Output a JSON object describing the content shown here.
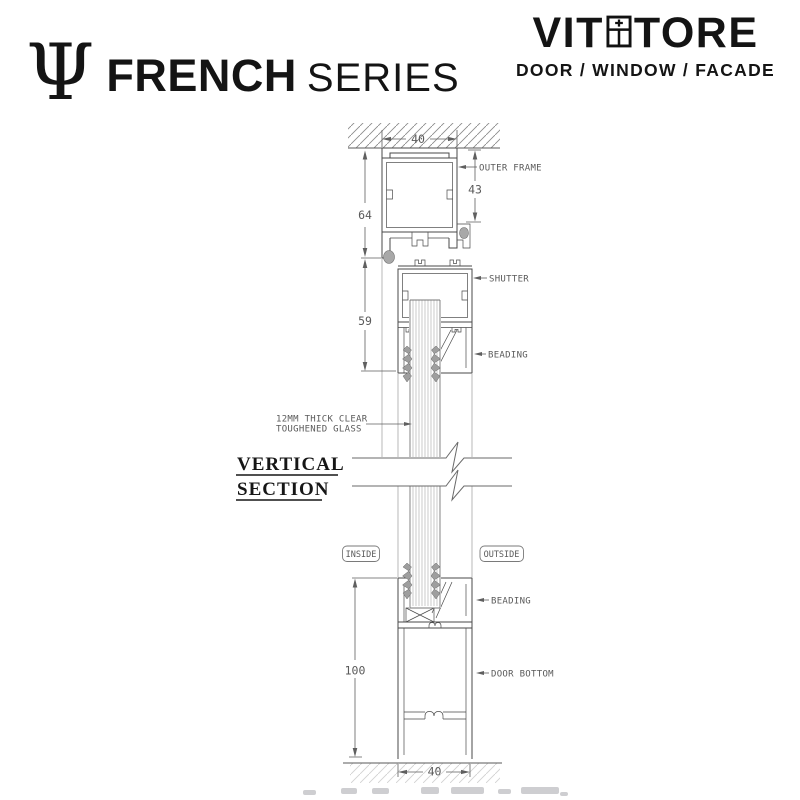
{
  "brand_left": {
    "symbol": "Ψ",
    "title": "FRENCH",
    "subtitle": "SERIES"
  },
  "brand_right": {
    "name_prefix": "VIT",
    "name_suffix": "TORE",
    "tagline": "DOOR / WINDOW / FACADE"
  },
  "drawing": {
    "title_line1": "VERTICAL",
    "title_line2": "SECTION",
    "labels": {
      "outer_frame": "OUTER FRAME",
      "shutter": "SHUTTER",
      "beading_top": "BEADING",
      "glass_line1": "12MM THICK CLEAR",
      "glass_line2": "TOUGHENED GLASS",
      "inside": "INSIDE",
      "outside": "OUTSIDE",
      "beading_bottom": "BEADING",
      "door_bottom": "DOOR BOTTOM"
    },
    "dimensions": {
      "top_width": "40",
      "outer_frame_height": "64",
      "frame_face": "43",
      "shutter_height": "59",
      "door_bottom_height": "100",
      "bottom_width": "40"
    }
  }
}
